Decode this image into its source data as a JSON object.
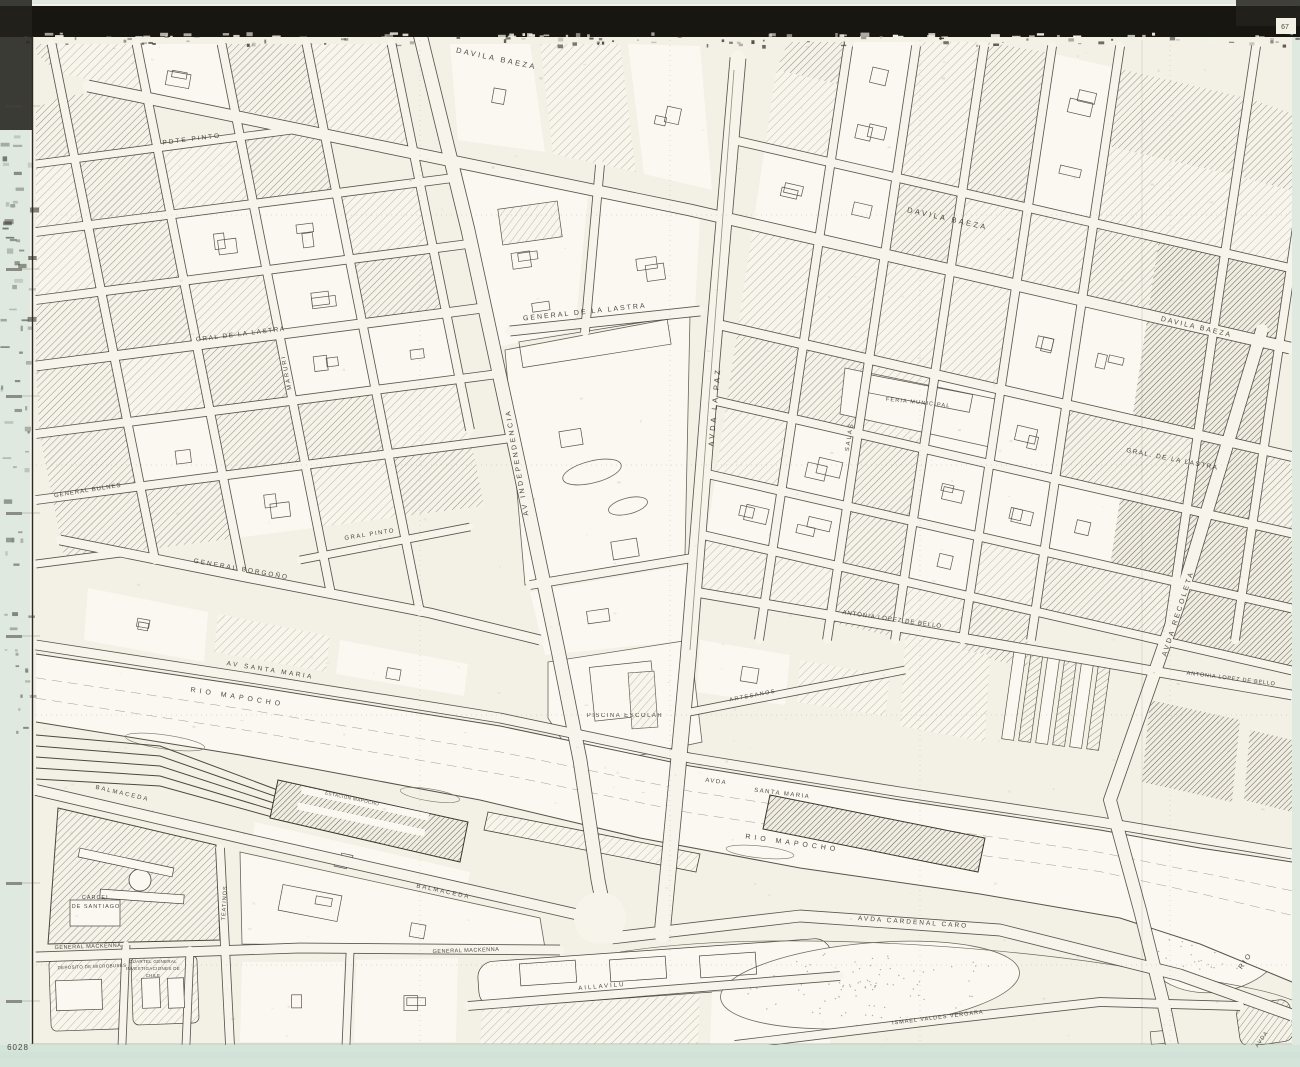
{
  "sheet": {
    "description_title": "Scanned city map sheet — Rio Mapocho / Estacion Mapocho district",
    "corner_mark_top_right": "67",
    "corner_mark_bottom_left": "6028"
  },
  "colors": {
    "margin_green": "#dfe9df",
    "strip_green": "#d5e4d8",
    "strip_aqua": "#cfe2d8",
    "band_dark": "#181611",
    "paper": "#f3f1e6",
    "paper_bright": "#faf8f0",
    "street_fill": "#f6f4eb",
    "ink": "#46423a",
    "casing": "#4a4540",
    "hatch_light": "#a39d8f",
    "hatch_med": "#7d7769",
    "hatch_dark": "#565043",
    "label_ink": "#3e3a33"
  },
  "map_labels": [
    {
      "id": "davila-baeza-1",
      "text": "DAVILA BAEZA",
      "x": 496,
      "y": 61,
      "rot": 12,
      "size": 7.5,
      "sp": 2.5
    },
    {
      "id": "davila-baeza-2",
      "text": "DAVILA BAEZA",
      "x": 947,
      "y": 221,
      "rot": 12.5,
      "size": 7.5,
      "sp": 2.5
    },
    {
      "id": "davila-baeza-3",
      "text": "DAVILA BAEZA",
      "x": 1196,
      "y": 329,
      "rot": 13,
      "size": 7,
      "sp": 2
    },
    {
      "id": "pdte-pinto",
      "text": "PDTE PINTO",
      "x": 192,
      "y": 141,
      "rot": -7,
      "size": 6.5,
      "sp": 2
    },
    {
      "id": "gral-de-la-lastra-left",
      "text": "GRAL DE LA LASTRA",
      "x": 241,
      "y": 336,
      "rot": -7,
      "size": 6.5,
      "sp": 1.5
    },
    {
      "id": "general-de-la-lastra",
      "text": "GENERAL DE LA LASTRA",
      "x": 585,
      "y": 314,
      "rot": -6,
      "size": 7,
      "sp": 2
    },
    {
      "id": "gral-de-la-lastra-right",
      "text": "GRAL. DE LA LASTRA",
      "x": 1172,
      "y": 461,
      "rot": 11,
      "size": 6.5,
      "sp": 1.5
    },
    {
      "id": "avda-la-paz",
      "text": "AVDA LA PAZ",
      "x": 717,
      "y": 407,
      "rot": -85,
      "size": 7.5,
      "sp": 3
    },
    {
      "id": "av-independencia",
      "text": "AV INDEPENDENCIA",
      "x": 519,
      "y": 462,
      "rot": -100,
      "size": 7,
      "sp": 2.5
    },
    {
      "id": "maruri",
      "text": "MARURI",
      "x": 288,
      "y": 372,
      "rot": -101,
      "size": 6,
      "sp": 2
    },
    {
      "id": "salas",
      "text": "SALAS",
      "x": 851,
      "y": 437,
      "rot": -81,
      "size": 6,
      "sp": 2
    },
    {
      "id": "avda-recoleta",
      "text": "AVDA RECOLETA",
      "x": 1180,
      "y": 614,
      "rot": -72,
      "size": 7,
      "sp": 2.5
    },
    {
      "id": "gral-pinto",
      "text": "GRAL PINTO",
      "x": 370,
      "y": 536,
      "rot": -9,
      "size": 6,
      "sp": 1.5
    },
    {
      "id": "general-bulnes",
      "text": "GENERAL BULNES",
      "x": 88,
      "y": 492,
      "rot": -9,
      "size": 6,
      "sp": 1
    },
    {
      "id": "general-borgono",
      "text": "GENERAL BORGOÑO",
      "x": 241,
      "y": 571,
      "rot": 10,
      "size": 6.5,
      "sp": 2
    },
    {
      "id": "av-santa-maria",
      "text": "AV SANTA MARIA",
      "x": 270,
      "y": 672,
      "rot": 9,
      "size": 6.5,
      "sp": 2.5
    },
    {
      "id": "rio-mapocho-1",
      "text": "RIO MAPOCHO",
      "x": 237,
      "y": 699,
      "rot": 9,
      "size": 7,
      "sp": 4
    },
    {
      "id": "rio-mapocho-2",
      "text": "RIO MAPOCHO",
      "x": 792,
      "y": 845,
      "rot": 8,
      "size": 7,
      "sp": 4
    },
    {
      "id": "avda-santa-maria-2a",
      "text": "AVDA",
      "x": 716,
      "y": 783,
      "rot": 7,
      "size": 6,
      "sp": 1.5
    },
    {
      "id": "avda-santa-maria-2b",
      "text": "SANTA MARIA",
      "x": 782,
      "y": 795,
      "rot": 7,
      "size": 6,
      "sp": 1.5
    },
    {
      "id": "piscina-escolar",
      "text": "PISCINA ESCOLAR",
      "x": 625,
      "y": 717,
      "rot": 0,
      "size": 6,
      "sp": 1.5
    },
    {
      "id": "artesanos",
      "text": "ARTESANOS",
      "x": 753,
      "y": 697,
      "rot": -11,
      "size": 5.5,
      "sp": 1.5
    },
    {
      "id": "antonia-lopez-de-bello-1",
      "text": "ANTONIA LOPEZ DE BELLO",
      "x": 892,
      "y": 621,
      "rot": 8,
      "size": 6,
      "sp": 1
    },
    {
      "id": "antonia-lopez-de-bello-2",
      "text": "ANTONIA LOPEZ DE BELLO",
      "x": 1231,
      "y": 680,
      "rot": 7,
      "size": 5.5,
      "sp": 0.8
    },
    {
      "id": "feria-municipal",
      "text": "FERIA MUNICIPAL",
      "x": 918,
      "y": 404,
      "rot": 6,
      "size": 5.5,
      "sp": 1.2
    },
    {
      "id": "balmaceda-1",
      "text": "BALMACEDA",
      "x": 122,
      "y": 795,
      "rot": 13,
      "size": 6,
      "sp": 2
    },
    {
      "id": "balmaceda-2",
      "text": "BALMACEDA",
      "x": 443,
      "y": 893,
      "rot": 12,
      "size": 6,
      "sp": 2
    },
    {
      "id": "general-mackenna-1",
      "text": "GENERAL MACKENNA",
      "x": 88,
      "y": 948,
      "rot": -2,
      "size": 5.5,
      "sp": 0.5
    },
    {
      "id": "general-mackenna-2",
      "text": "GENERAL MACKENNA",
      "x": 466,
      "y": 952,
      "rot": -2,
      "size": 5.5,
      "sp": 0.5
    },
    {
      "id": "carcel-1",
      "text": "CARCEL",
      "x": 96,
      "y": 899,
      "rot": 0,
      "size": 5.5,
      "sp": 1
    },
    {
      "id": "carcel-2",
      "text": "DE SANTIAGO",
      "x": 96,
      "y": 908,
      "rot": 0,
      "size": 5.5,
      "sp": 1
    },
    {
      "id": "teatinos",
      "text": "TEATINOS",
      "x": 226,
      "y": 903,
      "rot": -87,
      "size": 5.5,
      "sp": 1
    },
    {
      "id": "deposito-de-microbuses",
      "text": "DEPOSITO DE MICROBUSES",
      "x": 92,
      "y": 968,
      "rot": -2,
      "size": 4.5,
      "sp": 0.3
    },
    {
      "id": "cuartel-1",
      "text": "CUARTEL GENERAL",
      "x": 153,
      "y": 963,
      "rot": 0,
      "size": 4.5,
      "sp": 0.3
    },
    {
      "id": "cuartel-2",
      "text": "INVESTIGACIONES DE",
      "x": 153,
      "y": 970,
      "rot": 0,
      "size": 4.5,
      "sp": 0.3
    },
    {
      "id": "cuartel-3",
      "text": "CHILE",
      "x": 153,
      "y": 977,
      "rot": 0,
      "size": 4.5,
      "sp": 0.3
    },
    {
      "id": "aillavilu",
      "text": "AILLAVILU",
      "x": 602,
      "y": 988,
      "rot": -5,
      "size": 6,
      "sp": 2
    },
    {
      "id": "avda-cardenal-caro",
      "text": "AVDA  CARDENAL CARO",
      "x": 913,
      "y": 924,
      "rot": 4,
      "size": 6.5,
      "sp": 2
    },
    {
      "id": "ismael-valdes-vergara",
      "text": "ISMAEL VALDES VERGARA",
      "x": 938,
      "y": 1019,
      "rot": -7,
      "size": 5.5,
      "sp": 1
    },
    {
      "id": "estacion-mapocho",
      "text": "ESTACION MAPOCHO",
      "x": 352,
      "y": 800,
      "rot": 12,
      "size": 4.5,
      "sp": 0.5
    },
    {
      "id": "rio",
      "text": "RIO",
      "x": 1247,
      "y": 962,
      "rot": -55,
      "size": 7,
      "sp": 2
    },
    {
      "id": "avda-corner",
      "text": "AVDA",
      "x": 1263,
      "y": 1040,
      "rot": -55,
      "size": 5.5,
      "sp": 1
    },
    {
      "id": "sheet-67",
      "text": "67",
      "x": 1285,
      "y": 29,
      "rot": 0,
      "size": 7,
      "sp": 0
    },
    {
      "id": "sheet-6028",
      "text": "6028",
      "x": 18,
      "y": 1050,
      "rot": 0,
      "size": 8,
      "sp": 1
    }
  ]
}
